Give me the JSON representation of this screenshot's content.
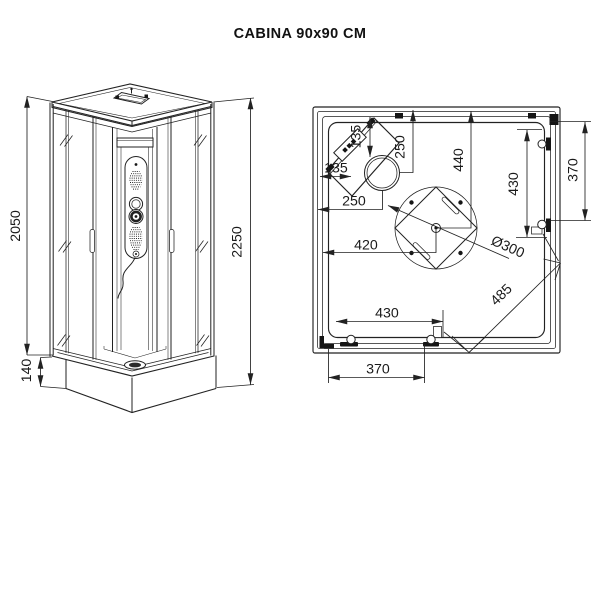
{
  "title": "CABINA 90x90 CM",
  "front_view": {
    "dim_glass_height": "2050",
    "dim_total_height": "2250",
    "dim_base_height": "140"
  },
  "plan_view": {
    "dim_corner_wall_top": "135",
    "dim_corner_wall_left": "135",
    "dim_head_from_top": "250",
    "dim_head_from_left": "250",
    "dim_center_from_top": "440",
    "dim_center_from_left": "420",
    "dim_right_wall_bracket": "430",
    "dim_right_wall_outer": "370",
    "dim_bottom_wall_inner": "430",
    "dim_bottom_wall_outer": "370",
    "dim_drain_diameter": "Ø300",
    "dim_diagonal_opening": "485"
  }
}
